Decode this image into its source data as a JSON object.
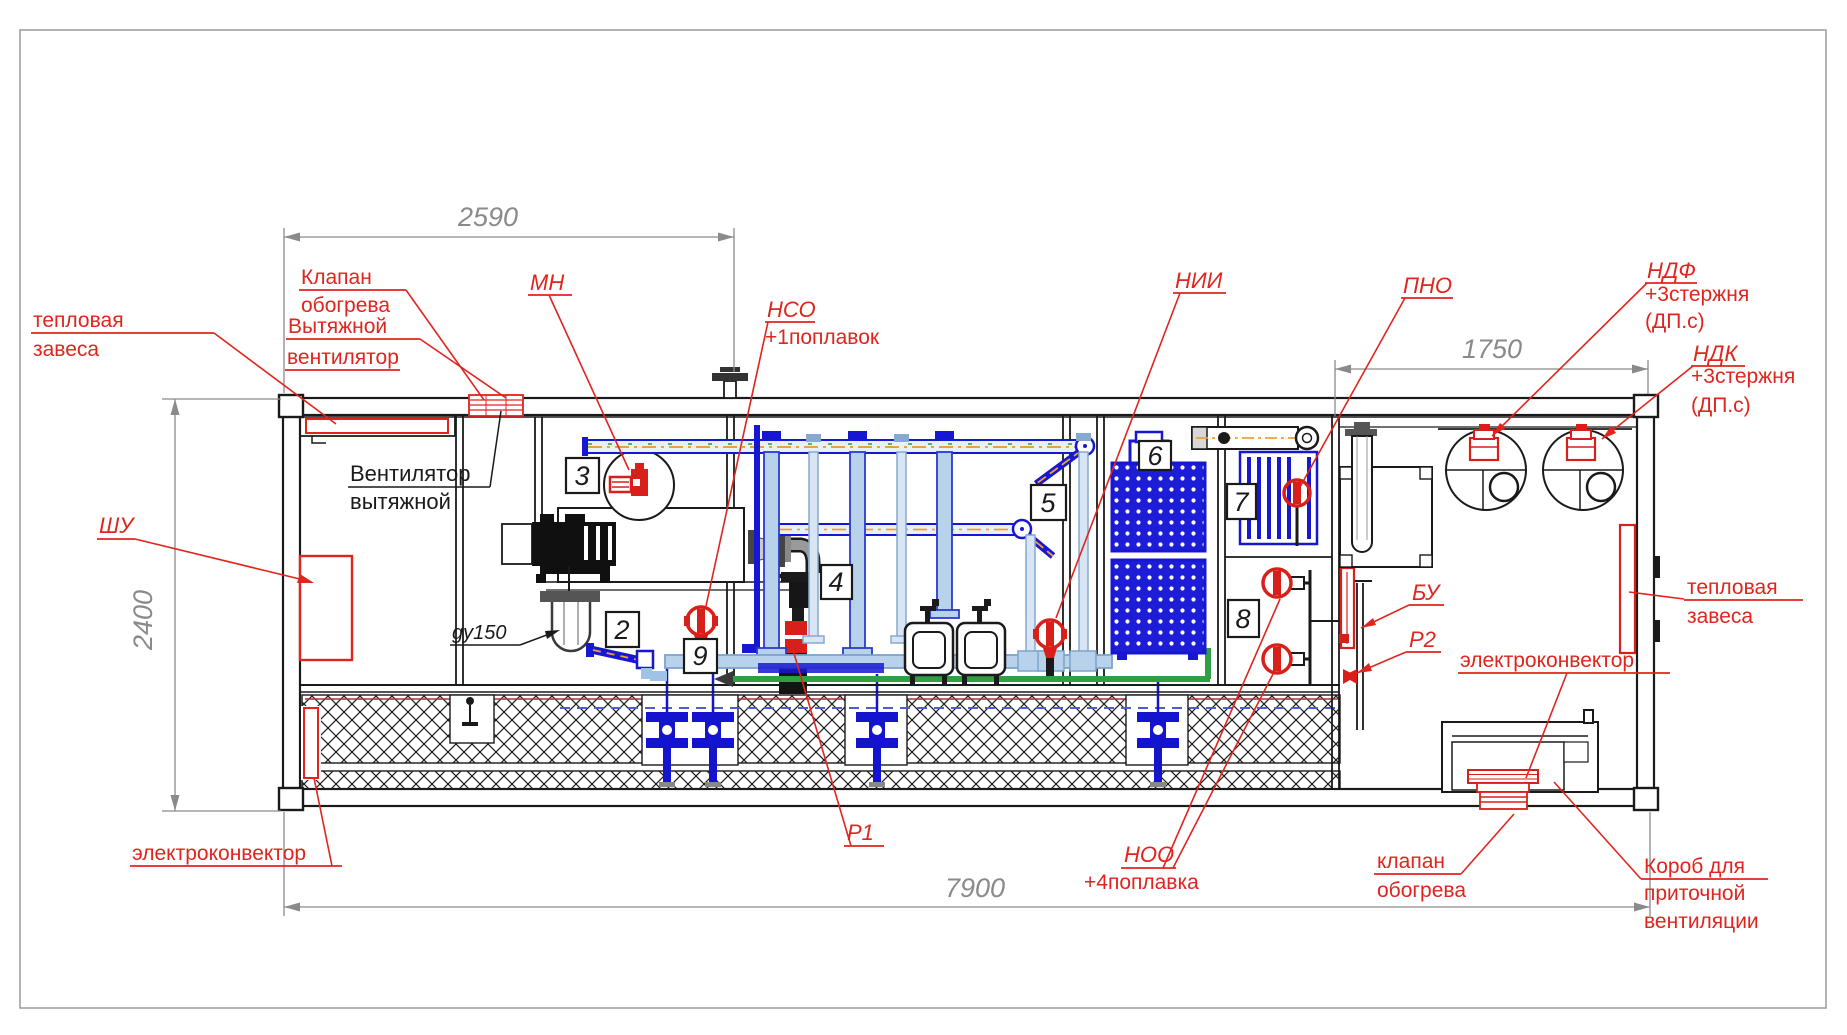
{
  "dimensions": {
    "top_left": "2590",
    "top_right": "1750",
    "height": "2400",
    "overall": "7900"
  },
  "sections": {
    "s2": "2",
    "s3": "3",
    "s4": "4",
    "s5": "5",
    "s6": "6",
    "s7": "7",
    "s8": "8",
    "s9": "9"
  },
  "labels": {
    "heat_curtain_left1": "тепловая",
    "heat_curtain_left2": "завеса",
    "heat_valve_top1": "Клапан",
    "heat_valve_top2": "обогрева",
    "exhaust_fan_red1": "Вытяжной",
    "exhaust_fan_red2": "вентилятор",
    "exhaust_fan_black1": "Вентилятор",
    "exhaust_fan_black2": "вытяжной",
    "mn": "МН",
    "nso": "НСО",
    "nso_note": "+1поплавок",
    "nii": "НИИ",
    "pno": "ПНО",
    "ndf": "НДФ",
    "ndf_note1": "+3стержня",
    "ndf_note2": "(ДП.с)",
    "ndk": "НДК",
    "ndk_note1": "+3стержня",
    "ndk_note2": "(ДП.с)",
    "shu": "ШУ",
    "du150": "gy150",
    "bu": "БУ",
    "r1": "Р1",
    "r2": "Р2",
    "noo": "НОО",
    "noo_note": "+4поплавка",
    "heat_curtain_right1": "тепловая",
    "heat_curtain_right2": "завеса",
    "electric_convector_right": "электроконвектор",
    "electric_convector_left": "электроконвектор",
    "heat_valve_bottom1": "клапан",
    "heat_valve_bottom2": "обогрева",
    "supply_duct1": "Короб для",
    "supply_duct2": "приточной",
    "supply_duct3": "вентиляции"
  },
  "colors": {
    "red": "#e0241e",
    "blue": "#1717d2",
    "light_blue": "#b9d2ec",
    "pale_blue": "#d7e5f4",
    "green": "#2f9e44",
    "orange": "#f0a036",
    "dim_gray": "#8a8a8a"
  }
}
